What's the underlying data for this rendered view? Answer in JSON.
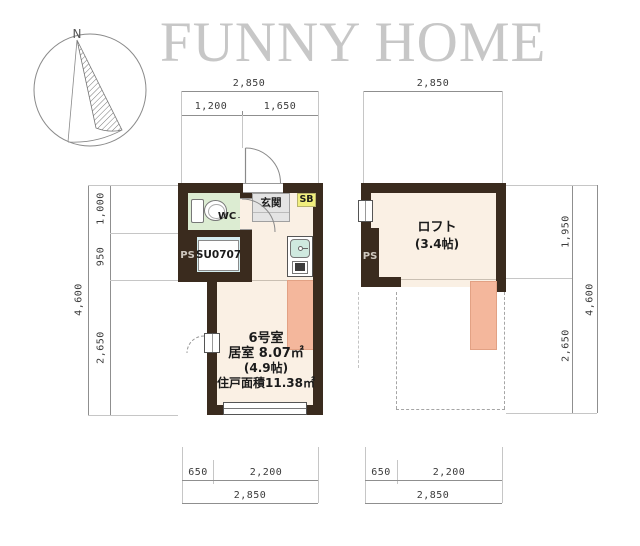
{
  "header": {
    "title": "FUNNY HOME"
  },
  "compass": {
    "north_label": "N"
  },
  "unit_plan": {
    "entrance_label": "玄関",
    "wc_label": "WC",
    "sb_label": "SB",
    "ps_label": "PS",
    "shower_unit_label": "SU0707",
    "room_name": "6号室",
    "room_area": "居室 8.07㎡",
    "room_tatami": "(4.9帖)",
    "total_area": "住戸面積11.38㎡",
    "dim_top_total": "2,850",
    "dim_top_left": "1,200",
    "dim_top_right": "1,650",
    "dim_left_1": "1,000",
    "dim_left_2": "950",
    "dim_left_3": "2,650",
    "dim_left_total": "4,600",
    "dim_bottom_left": "650",
    "dim_bottom_right": "2,200",
    "dim_bottom_total": "2,850"
  },
  "loft_plan": {
    "loft_label": "ロフト",
    "loft_tatami": "(3.4帖)",
    "ps_label": "PS",
    "dim_top_total": "2,850",
    "dim_right_1": "1,950",
    "dim_right_2": "2,650",
    "dim_right_total": "4,600",
    "dim_bottom_left": "650",
    "dim_bottom_right": "2,200",
    "dim_bottom_total": "2,850"
  },
  "colors": {
    "wall": "#3a2b1e",
    "floor": "#faf0e4",
    "ladder_area": "#f4b79c",
    "wc_green": "#dcecd2",
    "shower_cyan": "#d4edf0",
    "shoebox_yellow": "#f1ee7d",
    "title_gray": "#c7c7c7"
  }
}
